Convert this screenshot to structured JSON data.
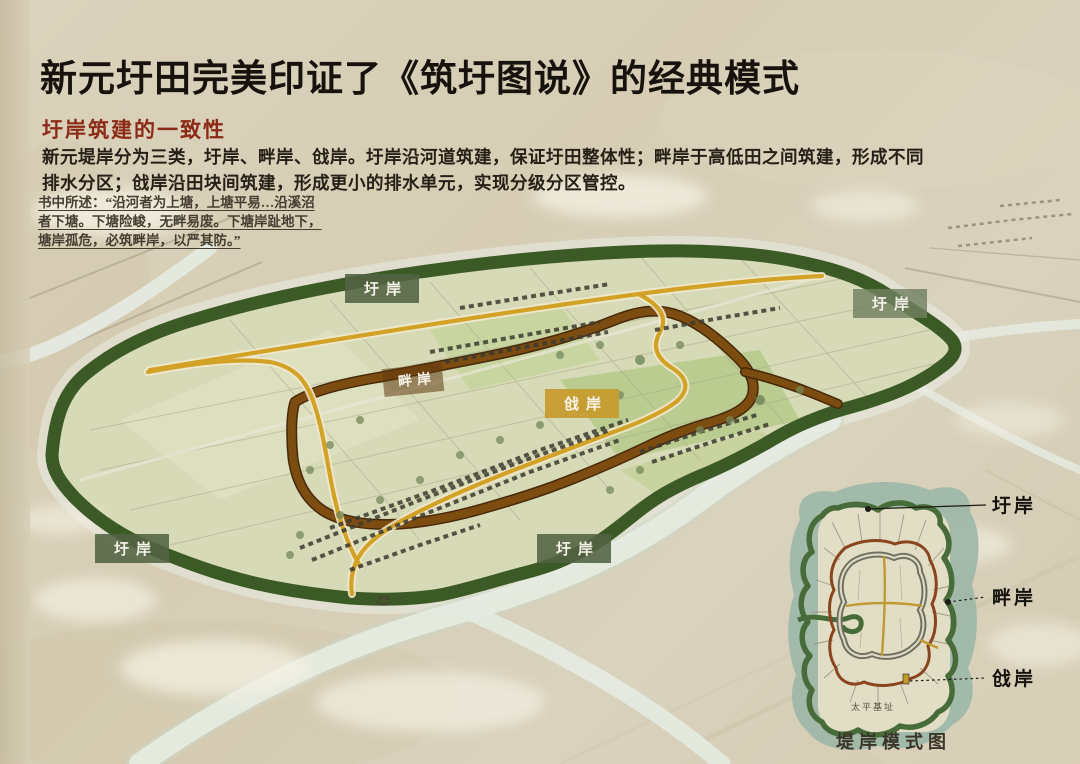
{
  "header": {
    "title": "新元圩田完美印证了《筑圩图说》的经典模式",
    "subtitle": "圩岸筑建的一致性",
    "body": [
      "新元堤岸分为三类，圩岸、畔岸、戗岸。圩岸沿河道筑建，保证圩田整体性；畔岸于高低田之间筑建，形成不同",
      "排水分区；戗岸沿田块间筑建，形成更小的排水单元，实现分级分区管控。"
    ],
    "quote": [
      "书中所述：“沿河者为上塘，上塘平易…沿溪沼",
      "者下塘。下塘险峻，无畔易废。下塘岸趾地下，",
      "塘岸孤危，必筑畔岸，以严其防。”"
    ]
  },
  "map": {
    "labels": [
      {
        "id": "yuan-top",
        "text": "圩岸"
      },
      {
        "id": "yuan-top-right",
        "text": "圩岸"
      },
      {
        "id": "panan",
        "text": "畔岸"
      },
      {
        "id": "qiangan",
        "text": "戗岸"
      },
      {
        "id": "yuan-bottom-left",
        "text": "圩岸"
      },
      {
        "id": "yuan-bottom-mid",
        "text": "圩岸"
      }
    ]
  },
  "inset": {
    "legend": [
      {
        "text": "圩岸"
      },
      {
        "text": "畔岸"
      },
      {
        "text": "戗岸"
      }
    ],
    "site": "太平基址",
    "caption": "堤岸模式图"
  },
  "colors": {
    "paper": "#d6cdb4",
    "accent_red": "#8b2b16",
    "ridge_green": "#3c5a26",
    "road_brown": "#7a4a10",
    "road_yellow": "#d2a226",
    "label_olive": "#526242",
    "label_gold": "#c79b2d",
    "water": "#e6ebe2",
    "inset_water": "#9db7a7"
  }
}
